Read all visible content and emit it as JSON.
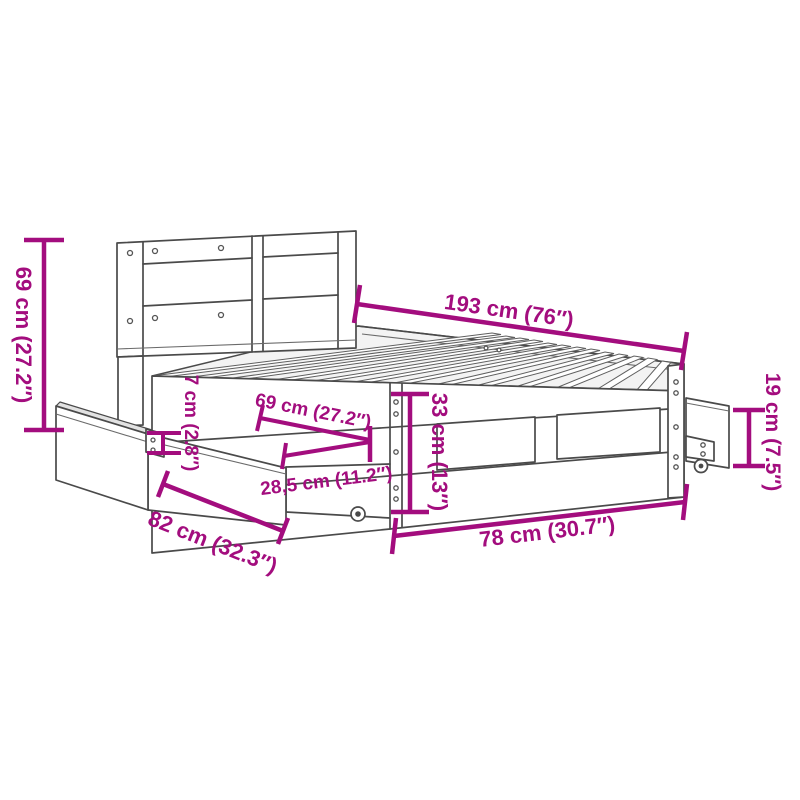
{
  "meta": {
    "background_color": "#ffffff",
    "accent_color": "#A30D7E",
    "lineart_color": "#4a4a4a",
    "subject": "bed frame with headboard and pull-out drawers, dimension diagram"
  },
  "labels": {
    "headboard_height": "69 cm (27.2″)",
    "length": "193 cm (76″)",
    "drawer_depth": "69 cm (27.2″)",
    "drawer_extension": "28,5 cm (11.2″)",
    "rail_height": "7 cm (2.8″)",
    "frame_height": "33 cm (13″)",
    "drawer_height": "19 cm (7.5″)",
    "drawer_width": "82 cm (32.3″)",
    "width": "78 cm (30.7″)"
  }
}
